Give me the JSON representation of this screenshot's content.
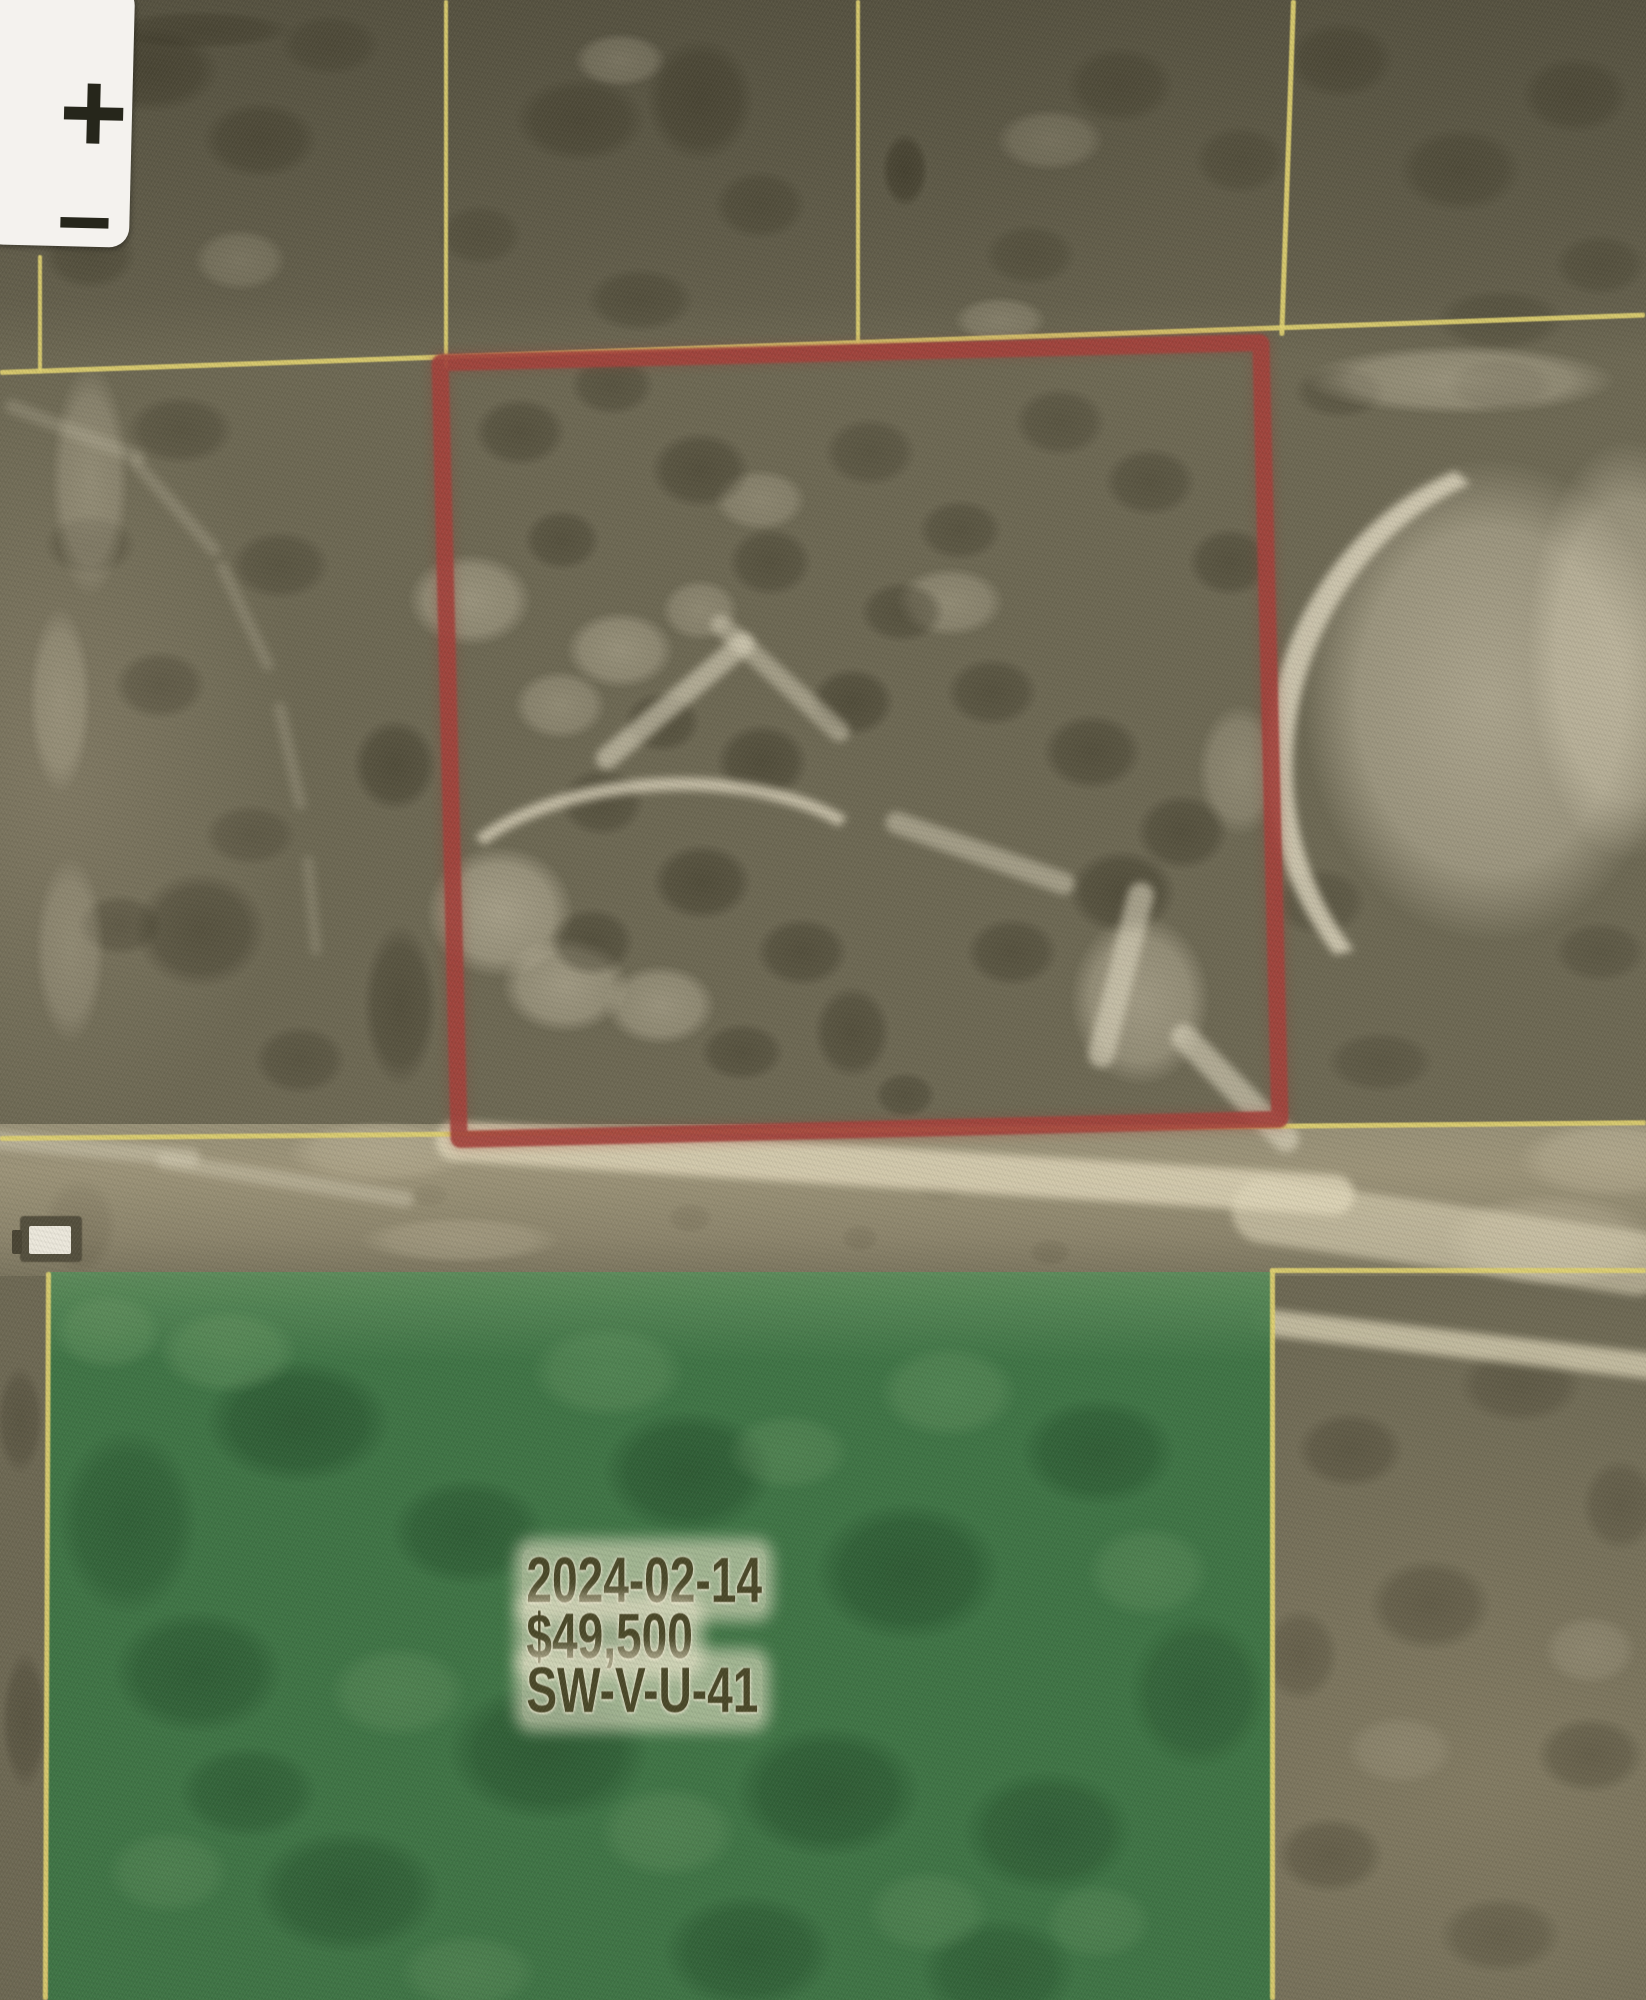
{
  "map": {
    "description": "Aerial parcel map with selected lot outline and sold-parcel overlay",
    "zoom_control": {
      "zoom_in_label": "+",
      "zoom_out_label": "−"
    },
    "sold_overlay": {
      "date": "2024-02-14",
      "price": "$49,500",
      "parcel_code": "SW-V-U-41"
    },
    "colors": {
      "selection_red": "#a5423c",
      "parcel_line_yellow": "#e0d170",
      "sold_green": "#3f7646",
      "label_text": "#4b4929",
      "label_halo": "#f2ebd2",
      "control_background": "#f4f2ee",
      "control_glyph": "#26261b",
      "terrain_base": "#6e6954"
    }
  }
}
